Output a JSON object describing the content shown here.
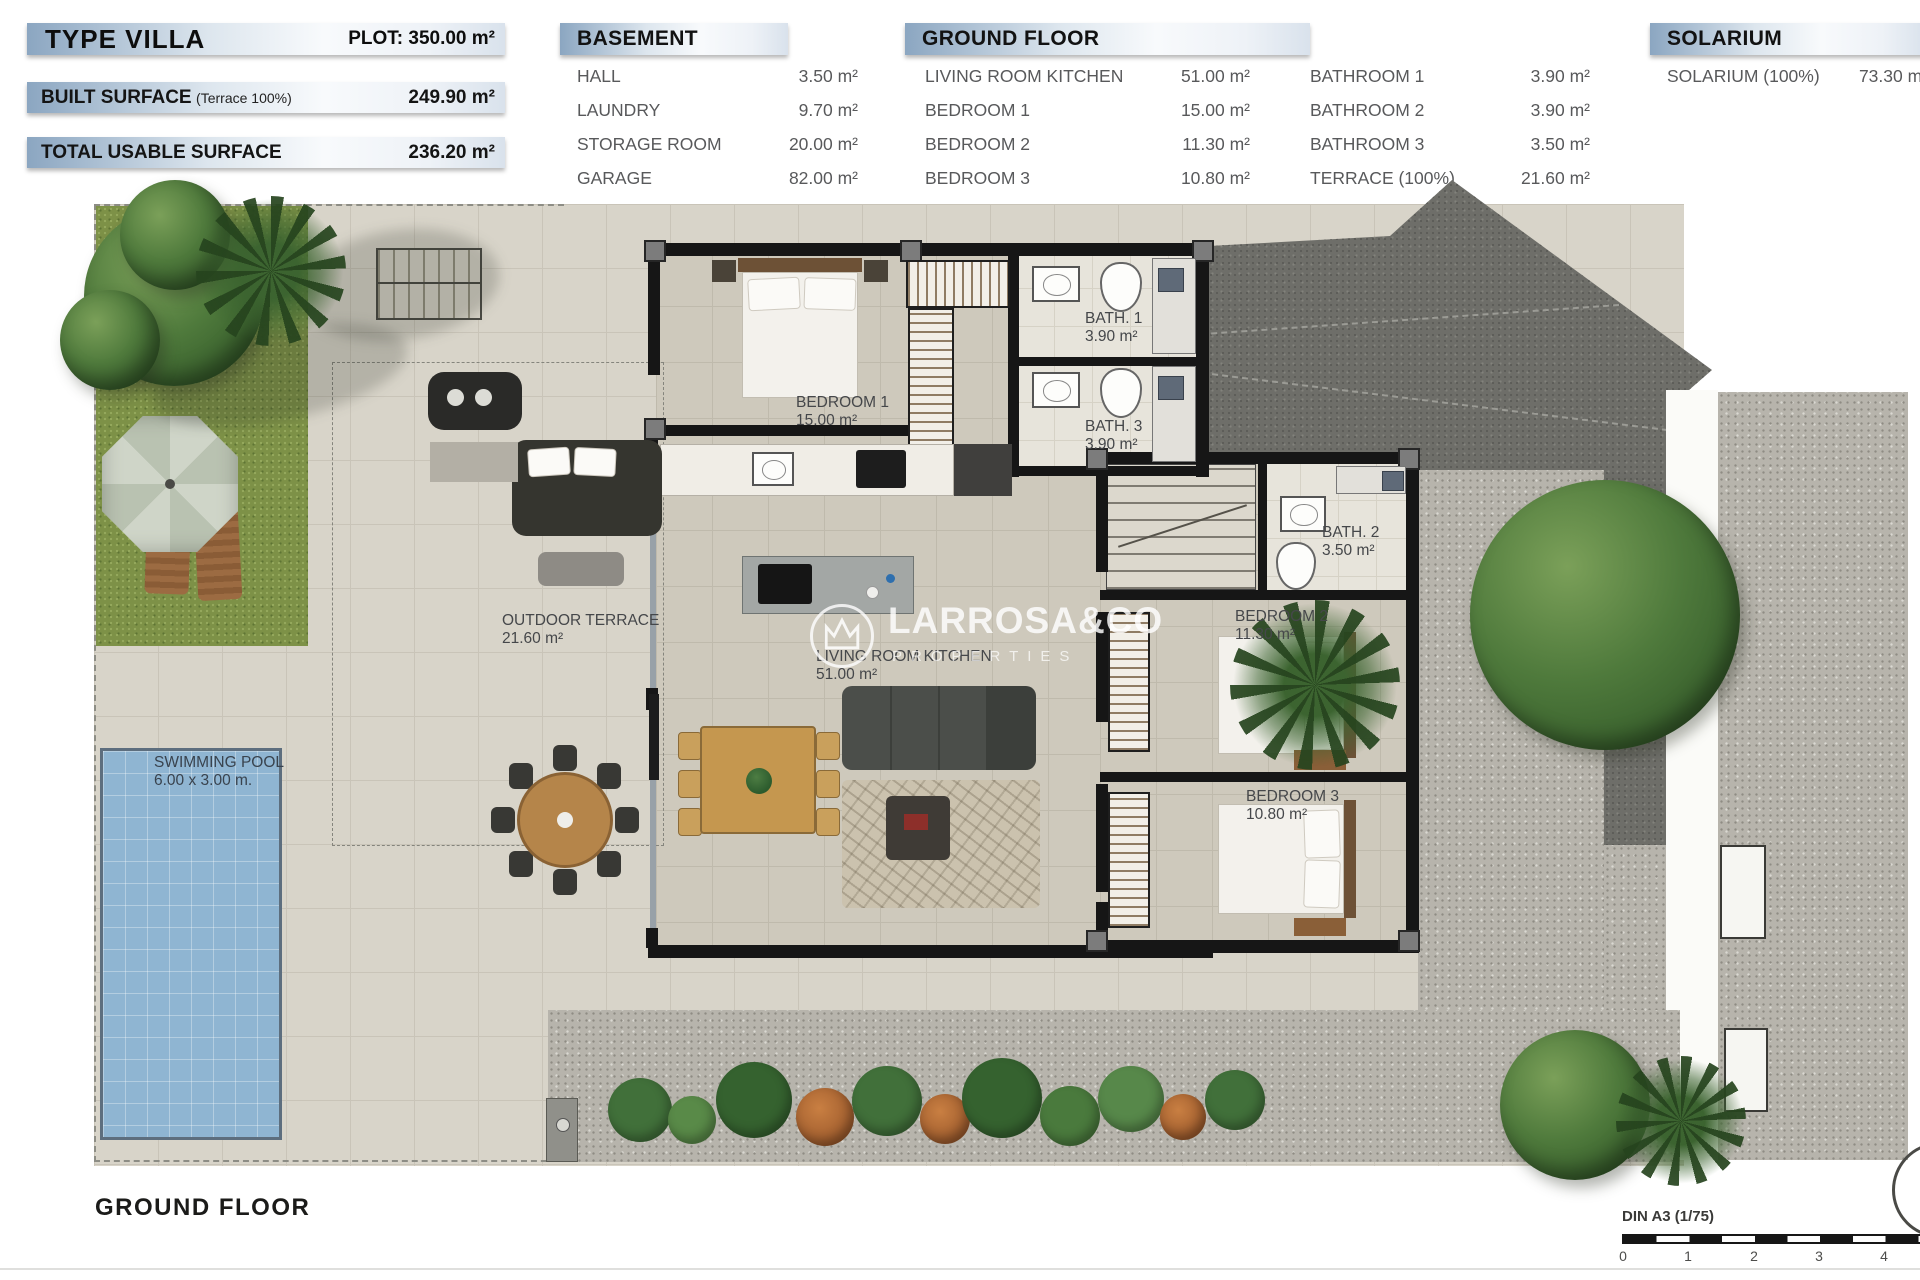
{
  "header": {
    "type_block": {
      "title": "TYPE VILLA",
      "plot": "PLOT: 350.00 m²",
      "built_label": "BUILT SURFACE",
      "built_sub": "(Terrace 100%)",
      "built_value": "249.90 m²",
      "usable_label": "TOTAL USABLE SURFACE",
      "usable_value": "236.20 m²"
    },
    "basement": {
      "title": "BASEMENT",
      "rows": [
        {
          "name": "HALL",
          "area": "3.50 m²"
        },
        {
          "name": "LAUNDRY",
          "area": "9.70 m²"
        },
        {
          "name": "STORAGE ROOM",
          "area": "20.00 m²"
        },
        {
          "name": "GARAGE",
          "area": "82.00 m²"
        }
      ]
    },
    "ground_floor": {
      "title": "GROUND FLOOR",
      "col1": [
        {
          "name": "LIVING ROOM KITCHEN",
          "area": "51.00 m²"
        },
        {
          "name": "BEDROOM 1",
          "area": "15.00 m²"
        },
        {
          "name": "BEDROOM 2",
          "area": "11.30 m²"
        },
        {
          "name": "BEDROOM 3",
          "area": "10.80 m²"
        }
      ],
      "col2": [
        {
          "name": "BATHROOM 1",
          "area": "3.90 m²"
        },
        {
          "name": "BATHROOM 2",
          "area": "3.90 m²"
        },
        {
          "name": "BATHROOM 3",
          "area": "3.50 m²"
        },
        {
          "name": "TERRACE (100%)",
          "area": "21.60 m²"
        }
      ]
    },
    "solarium": {
      "title": "SOLARIUM",
      "rows": [
        {
          "name": "SOLARIUM (100%)",
          "area": "73.30 m²"
        }
      ]
    }
  },
  "plan": {
    "rooms": {
      "bedroom1": {
        "name": "BEDROOM 1",
        "area": "15.00 m²"
      },
      "bath1": {
        "name": "BATH. 1",
        "area": "3.90 m²"
      },
      "bath3": {
        "name": "BATH. 3",
        "area": "3.90 m²"
      },
      "bath2": {
        "name": "BATH. 2",
        "area": "3.50 m²"
      },
      "bedroom2": {
        "name": "BEDROOM 2",
        "area": "11.30 m²"
      },
      "bedroom3": {
        "name": "BEDROOM 3",
        "area": "10.80 m²"
      },
      "living": {
        "name": "LIVING ROOM KITCHEN",
        "area": "51.00 m²"
      },
      "outdoor_terrace": {
        "name": "OUTDOOR TERRACE",
        "area": "21.60 m²"
      },
      "pool": {
        "name": "SWIMMING POOL",
        "size": "6.00 x 3.00 m."
      }
    }
  },
  "watermark": {
    "brand": "LARROSA&CO",
    "sub": "PROPERTIES"
  },
  "footer": {
    "title": "GROUND FLOOR",
    "scale_label": "DIN A3 (1/75)",
    "ticks": [
      "0",
      "1",
      "2",
      "3",
      "4"
    ]
  },
  "colors": {
    "header_bar_blue": "#8ba6c1",
    "pool_blue": "#8fb5d2",
    "grass_green": "#7d9147",
    "driveway_grey": "#6e6e69",
    "gravel_grey": "#b7b4ac",
    "label_grey": "#58595b"
  }
}
